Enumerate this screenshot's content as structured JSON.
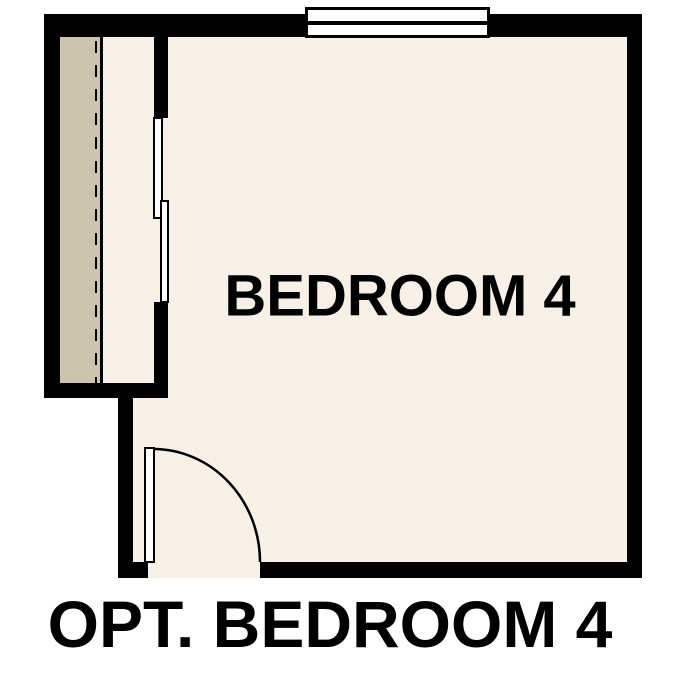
{
  "page": {
    "caption": "OPT. BEDROOM 4",
    "background_color": "#ffffff"
  },
  "floor_plan": {
    "room_label": "BEDROOM 4",
    "colors": {
      "wall": "#000000",
      "floor": "#f7f0e6",
      "closet_shelf": "#cdc4ae",
      "fixture_fill": "#ffffff",
      "label_text": "#000000"
    },
    "elements": {
      "window": "double-pane-window-top-wall",
      "closet_doors": "bypass-sliding-doors",
      "closet_rod": "dashed-rod-line",
      "entry_door": "hinged-door-90deg-swing-bottom-left"
    }
  }
}
